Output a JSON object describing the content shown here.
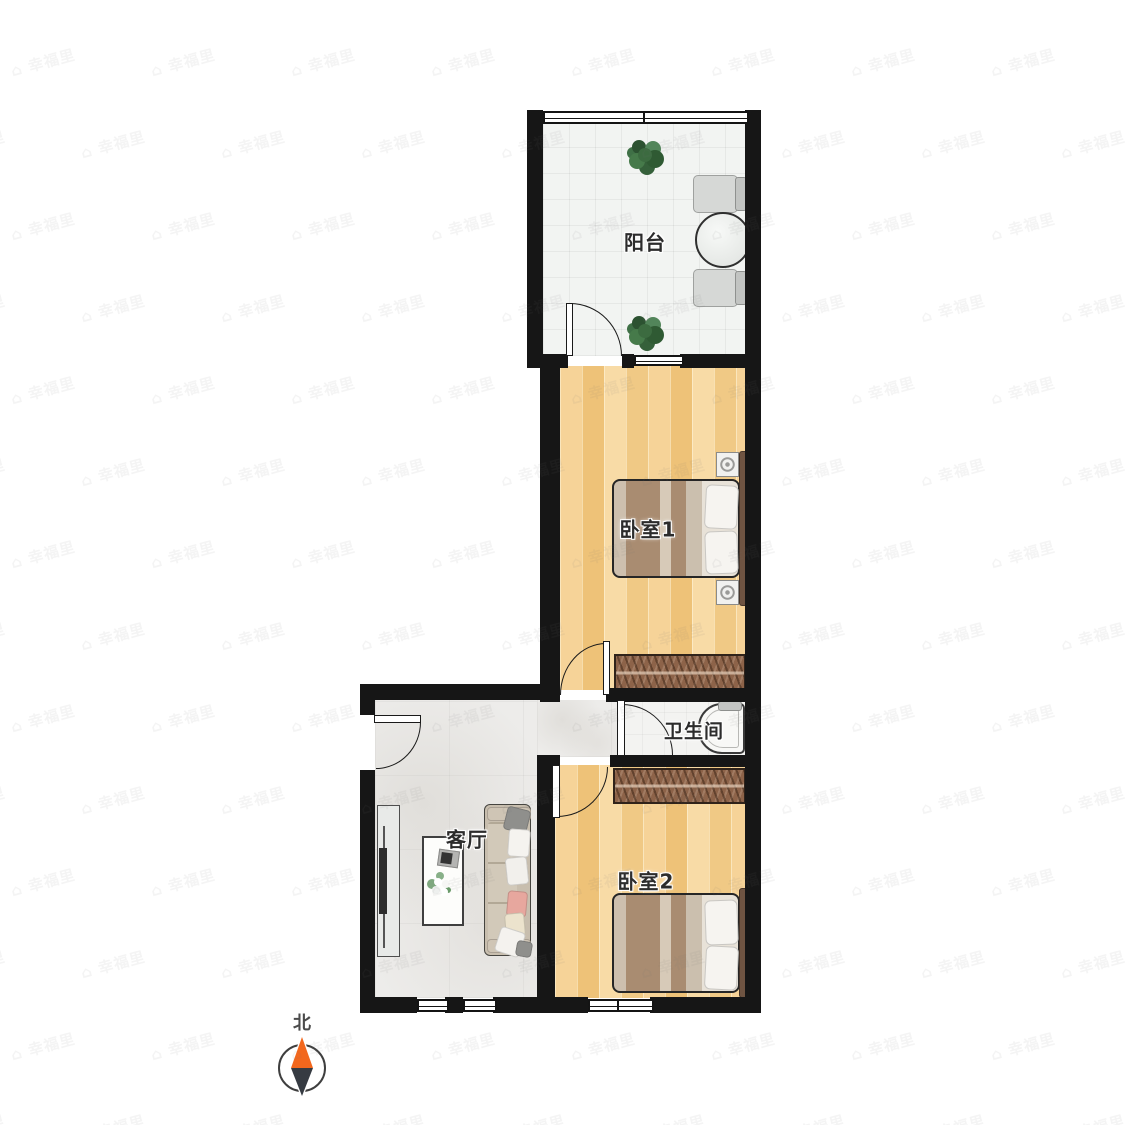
{
  "rooms": {
    "balcony": {
      "label": "阳台"
    },
    "bedroom1": {
      "label": "卧室1"
    },
    "bathroom": {
      "label": "卫生间"
    },
    "living": {
      "label": "客厅"
    },
    "bedroom2": {
      "label": "卧室2"
    }
  },
  "compass": {
    "north_label": "北"
  },
  "watermark": {
    "icon": "⌂",
    "text": "幸福里"
  },
  "colors": {
    "wall": "#161616",
    "wood_floor": "#f3cd8d",
    "balcony_tile": "#f2f4f2",
    "marble_floor": "#edecea",
    "wardrobe": "#8d6349",
    "north_needle_orange": "#f2671d",
    "north_needle_dark": "#363b42"
  }
}
